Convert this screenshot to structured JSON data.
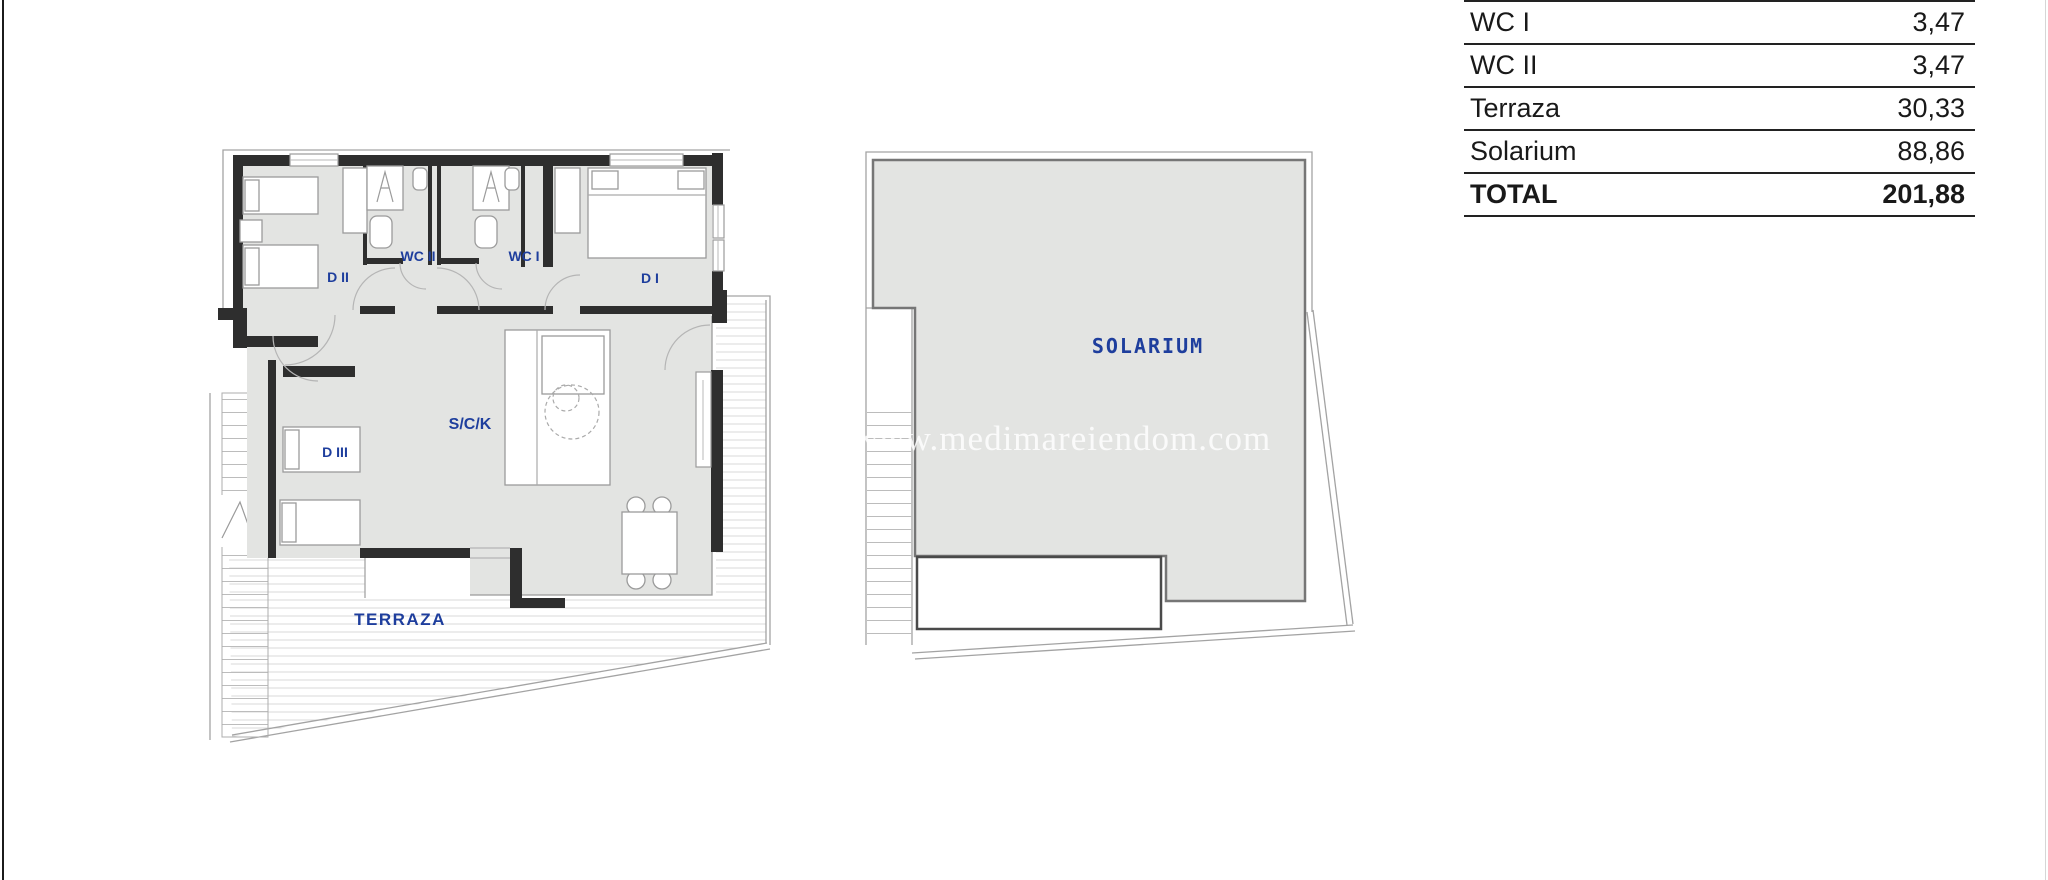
{
  "page": {
    "width": 2048,
    "height": 880,
    "background": "#ffffff"
  },
  "colors": {
    "accent_blue": "#1e3e9d",
    "plan_fill": "#e3e4e2",
    "wall_dark": "#2e2e2e",
    "table_line": "#222222",
    "thin_line": "#a3a3a3",
    "left_edge_line": "#1b1b1b"
  },
  "area_table": {
    "rows": [
      {
        "label": "WC I",
        "value": "3,47"
      },
      {
        "label": "WC II",
        "value": "3,47"
      },
      {
        "label": "Terraza",
        "value": "30,33"
      },
      {
        "label": "Solarium",
        "value": "88,86"
      },
      {
        "label": "TOTAL",
        "value": "201,88"
      }
    ]
  },
  "floor_plan": {
    "labels": {
      "d1": "D I",
      "d2": "D II",
      "d3": "D III",
      "wc1": "WC I",
      "wc2": "WC II",
      "sck": "S/C/K",
      "terraza": "TERRAZA"
    }
  },
  "solarium_plan": {
    "label": "SOLARIUM",
    "watermark": "www.medimareiendom.com"
  }
}
